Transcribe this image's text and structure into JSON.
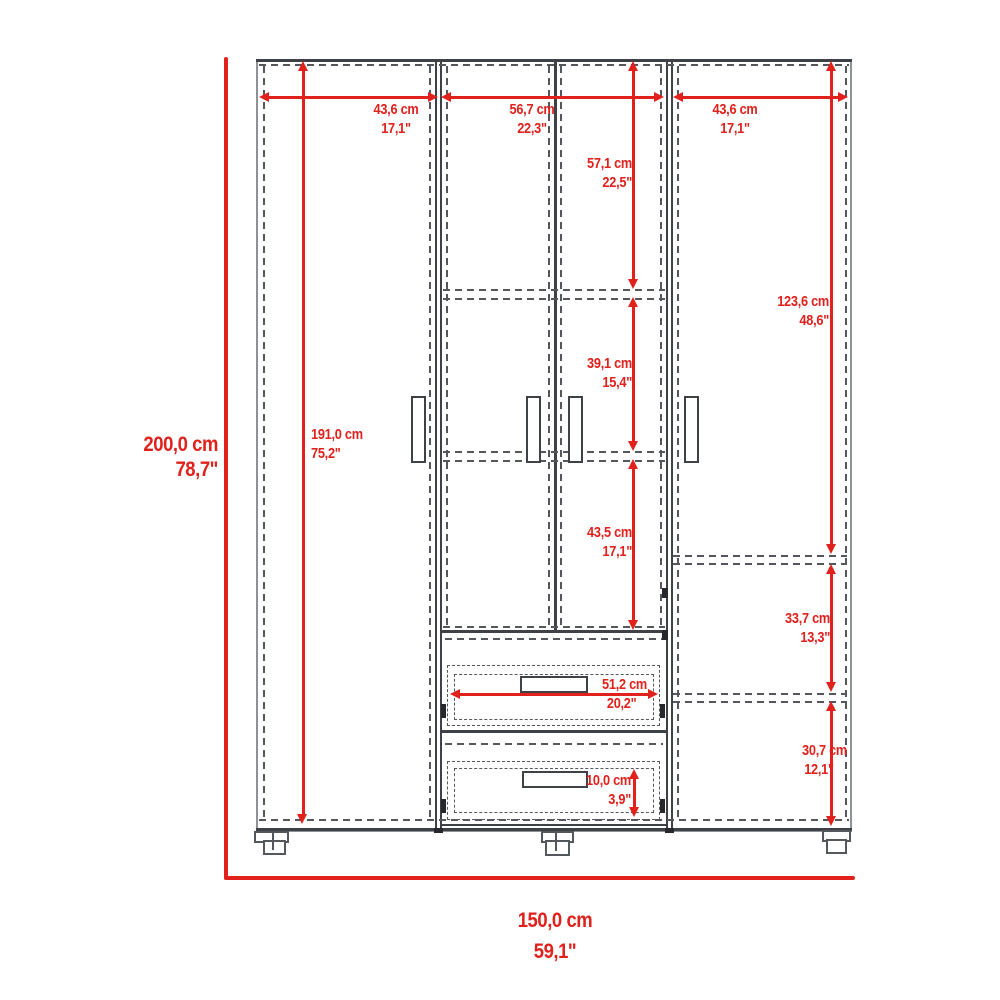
{
  "title": "wardrobe-dimension-diagram",
  "colors": {
    "dimension_red": "#e0211c",
    "cabinet_line_dark": "#3e4145",
    "cabinet_line_mid": "#54585c",
    "cabinet_line_light": "#8e9296",
    "background": "#ffffff"
  },
  "dims": {
    "overall_height": {
      "cm": "200,0 cm",
      "in": "78,7\""
    },
    "overall_width": {
      "cm": "150,0 cm",
      "in": "59,1\""
    },
    "interior_height": {
      "cm": "191,0 cm",
      "in": "75,2\""
    },
    "section_left_width": {
      "cm": "43,6 cm",
      "in": "17,1\""
    },
    "section_middle_width": {
      "cm": "56,7 cm",
      "in": "22,3\""
    },
    "section_right_width": {
      "cm": "43,6 cm",
      "in": "17,1\""
    },
    "middle_top_height": {
      "cm": "57,1 cm",
      "in": "22,5\""
    },
    "middle_shelf_gap": {
      "cm": "39,1 cm",
      "in": "15,4\""
    },
    "middle_bottom_height": {
      "cm": "43,5 cm",
      "in": "17,1\""
    },
    "right_top_height": {
      "cm": "123,6 cm",
      "in": "48,6\""
    },
    "right_shelf_gap": {
      "cm": "33,7 cm",
      "in": "13,3\""
    },
    "right_bottom_height": {
      "cm": "30,7 cm",
      "in": "12,1\""
    },
    "drawer_width": {
      "cm": "51,2 cm",
      "in": "20,2\""
    },
    "drawer_front_height": {
      "cm": "10,0 cm",
      "in": "3,9\""
    }
  }
}
